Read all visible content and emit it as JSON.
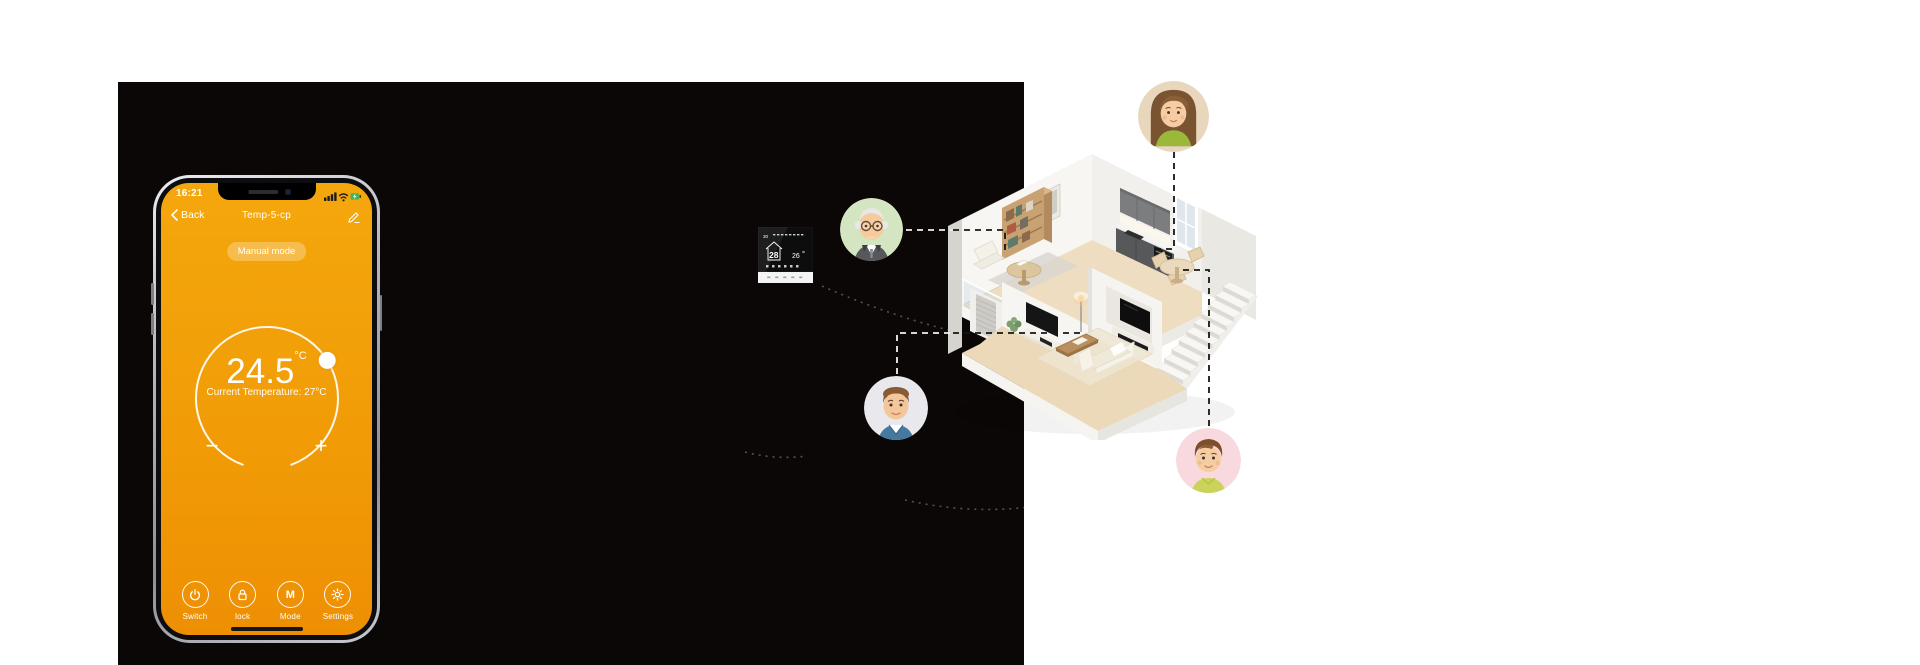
{
  "scene": {
    "background_color": "#ffffff",
    "panel_color": "#0b0707"
  },
  "phone": {
    "status_bar": {
      "time": "16:21",
      "icons": [
        "cellular-signal",
        "wifi",
        "battery-charging"
      ]
    },
    "nav": {
      "back_label": "Back",
      "title": "Temp-5-cp"
    },
    "mode_badge": "Manual mode",
    "dial": {
      "set_temp": "24.5",
      "unit": "°C",
      "current_label": "Current Temperature: 27°C"
    },
    "controls": {
      "decrease": "−",
      "increase": "+"
    },
    "toolbar": [
      {
        "icon": "power-icon",
        "label": "Switch"
      },
      {
        "icon": "lock-icon",
        "label": "lock"
      },
      {
        "icon": "mode-m-icon",
        "icon_letter": "M",
        "label": "Mode"
      },
      {
        "icon": "gear-icon",
        "label": "Settings"
      }
    ],
    "colors": {
      "screen_top": "#f4a70c",
      "screen_bottom": "#ee8f03",
      "text": "#ffffff",
      "battery": "#45b554"
    }
  },
  "thermostat_device": {
    "display_time": "30",
    "set_temp": "28",
    "current_temp": "26"
  },
  "family": [
    {
      "name": "mother",
      "avatar_bg": "#e8d7bc",
      "connected_room": "kitchen"
    },
    {
      "name": "grandfather",
      "avatar_bg": "#d3e5c1",
      "connected_room": "study-loft"
    },
    {
      "name": "father",
      "avatar_bg": "#e9e9ed",
      "connected_room": "living-room"
    },
    {
      "name": "son",
      "avatar_bg": "#f8d9dd",
      "connected_room": "dining-area"
    }
  ],
  "connector_colors": {
    "on_dark": "#f2f2f2",
    "on_light": "#161616"
  }
}
